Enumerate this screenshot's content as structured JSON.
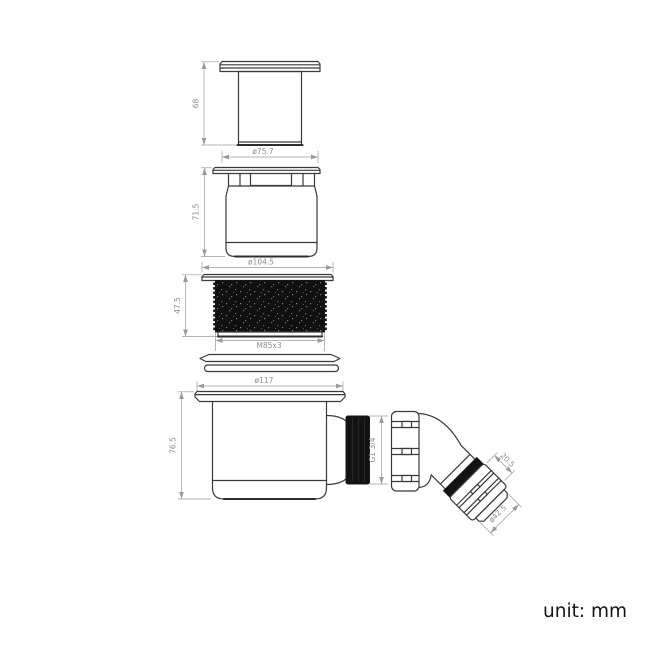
{
  "drawing": {
    "unit_label": "unit: mm",
    "parts": {
      "cap": {
        "height": "68",
        "diameter": "ø75.7"
      },
      "insert": {
        "height": "71.5"
      },
      "locknut": {
        "flange_diameter": "ø104.5",
        "height": "47.5",
        "thread": "M85x3"
      },
      "trap_body": {
        "flange_diameter": "ø117",
        "height": "76.5",
        "outlet_thread": "G1 3/4"
      },
      "elbow": {
        "nut_length": "20.5",
        "outlet_diameter": "ø42.5"
      }
    }
  },
  "colors": {
    "outline": "#3a3a3a",
    "dimension": "#9b9b9b",
    "fill_dark": "#121212",
    "background": "#ffffff"
  }
}
